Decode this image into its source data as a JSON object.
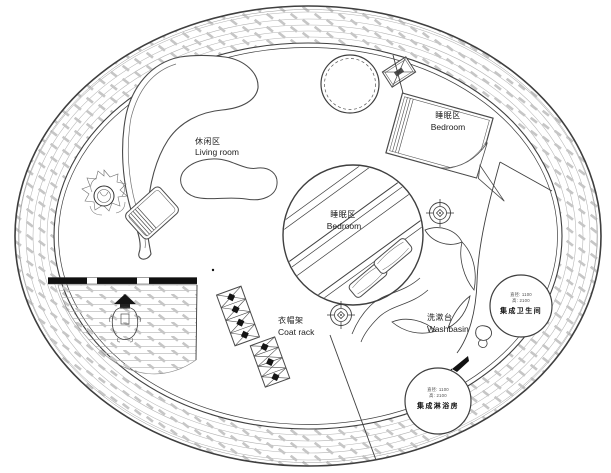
{
  "plan_title": "circular-house-floor-plan",
  "areas": {
    "living_room": {
      "zh": "休闲区",
      "en": "Living room"
    },
    "bedroom_upper": {
      "zh": "睡眠区",
      "en": "Bedroom"
    },
    "bedroom_center": {
      "zh": "睡眠区",
      "en": "Bedroom"
    },
    "coat_rack": {
      "zh": "衣帽架",
      "en": "Coat rack"
    },
    "washbasin": {
      "zh": "洗漱台",
      "en": "Washbasin"
    }
  },
  "pods": {
    "bathroom": {
      "dim_line1": "直径: 1100",
      "dim_line2": "高: 2100",
      "name": "集成卫生间"
    },
    "shower": {
      "dim_line1": "直径: 1100",
      "dim_line2": "高: 2100",
      "name": "集成淋浴房"
    }
  },
  "colors": {
    "line": "#3f3f3f",
    "hatch_line": "#b2b2b2",
    "hatch_dash": "#c6c6c6",
    "text": "#1d1d1d",
    "background": "#ffffff"
  }
}
